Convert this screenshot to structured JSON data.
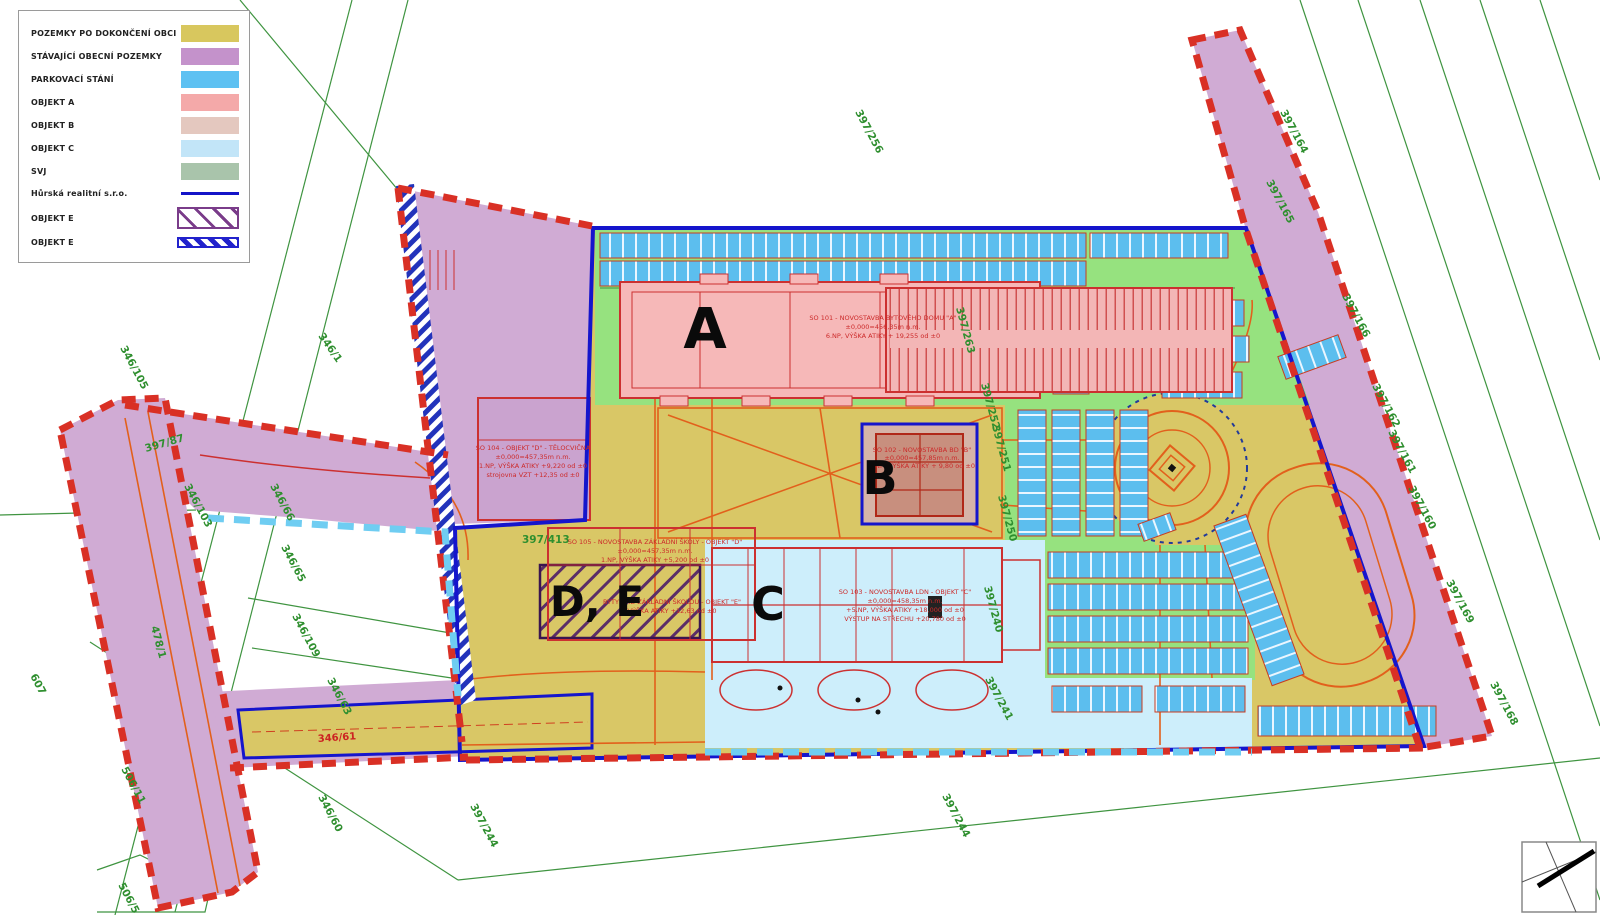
{
  "legend": {
    "items": [
      {
        "label": "POZEMKY PO DOKONČENÍ OBCI",
        "swatch": "solid",
        "color": "#d8c75e"
      },
      {
        "label": "STÁVAJÍCÍ OBECNÍ POZEMKY",
        "swatch": "solid",
        "color": "#c492cb"
      },
      {
        "label": "PARKOVACÍ STÁNÍ",
        "swatch": "solid",
        "color": "#5ec1f2"
      },
      {
        "label": "OBJEKT A",
        "swatch": "solid",
        "color": "#f4a9a9"
      },
      {
        "label": "OBJEKT B",
        "swatch": "solid",
        "color": "#e4c8bf"
      },
      {
        "label": "OBJEKT C",
        "swatch": "solid",
        "color": "#c2e5f8"
      },
      {
        "label": "SVJ",
        "swatch": "solid",
        "color": "#a9c4ab"
      },
      {
        "label": "Hůrská realitní s.r.o.",
        "swatch": "line",
        "color": "#1414c8"
      },
      {
        "label": "OBJEKT E",
        "swatch": "hatch-purple",
        "color": "#7a3c8a"
      },
      {
        "label": "OBJEKT E",
        "swatch": "hatch-blue",
        "color": "#2222cc"
      }
    ]
  },
  "map": {
    "letters": {
      "a": "A",
      "b": "B",
      "c": "C",
      "de": "D, E"
    },
    "annotations": {
      "a": {
        "line1": "SO 101 - NOVOSTAVBA BYTOVÉHO DOMU \"A\"",
        "line2": "±0,000=456,35m n.m.",
        "line3": "6.NP, VÝŠKA ATIKY + 19,255 od ±0"
      },
      "b": {
        "line1": "SO 102 - NOVOSTAVBA BD \"B\"",
        "line2": "±0,000=457,85m n.m.",
        "line3": "3.NP, VÝŠKA ATIKY + 9,80 od ±0"
      },
      "c": {
        "line1": "SO 103 - NOVOSTAVBA LDN - OBJEKT \"C\"",
        "line2": "±0,000=458,35m n.m.",
        "line3": "+5.NP, VÝŠKA ATIKY +18,000 od ±0",
        "line4": "VÝSTUP NA STŘECHU +20,780 od ±0"
      },
      "school": {
        "line1": "SO 105 - NOVOSTAVBA ZÁKLADNÍ ŠKOLY - OBJEKT \"D\"",
        "line2": "±0,000=457,35m n.m.",
        "line3": "1.NP, VÝŠKA ATIKY +5,200 od ±0"
      },
      "flats": {
        "line1": "BYTY NAD ZÁKLADNÍ ŠKOLOU - OBJEKT \"E\"",
        "line2": "VÝŠKA ATIKY +12,63 od ±0"
      },
      "gym": {
        "line1": "SO 104 - OBJEKT \"D\" - TĚLOCVIČNA",
        "line2": "±0,000=457,35m n.m.",
        "line3": "1.NP, VÝŠKA ATIKY +9,220 od ±0",
        "line4": "strojovna VZT +12,35 od ±0"
      }
    },
    "parcels": {
      "p346_1": "346/1",
      "p346_105": "346/105",
      "p346_103": "346/103",
      "p346_66": "346/66",
      "p346_65": "346/65",
      "p346_109": "346/109",
      "p346_63": "346/63",
      "p346_61": "346/61",
      "p346_60": "346/60",
      "p607": "607",
      "p506_11": "506/11",
      "p506_5": "506/5",
      "p478_1": "478/1",
      "p397_87": "397/87",
      "p397_244": "397/244",
      "p397_256": "397/256",
      "p397_252": "397/252",
      "p397_251": "397/251",
      "p397_250": "397/250",
      "p397_240": "397/240",
      "p397_241": "397/241",
      "p397_263": "397/263",
      "p397_413": "397/413",
      "p397_164": "397/164",
      "p397_165": "397/165",
      "p397_166": "397/166",
      "p397_162": "397/162",
      "p397_161": "397/161",
      "p397_160": "397/160",
      "p397_169": "397/169",
      "p397_168": "397/168"
    },
    "colors": {
      "site_yellow": "#d9c766",
      "municipal_purple": "#d0abd4",
      "parking_blue": "#5cbeee",
      "objekt_a_pink": "#f6b8b8",
      "objekt_b_beige": "#d6b4a8",
      "objekt_c_blue": "#cdeefb",
      "green_area": "#96e27f",
      "boundary_blue": "#1515cc",
      "boundary_red_dash": "#d93025",
      "boundary_lightblue_dash": "#6fcdf2",
      "road_orange": "#e2601c",
      "cadastre_green": "#3f9440"
    }
  }
}
